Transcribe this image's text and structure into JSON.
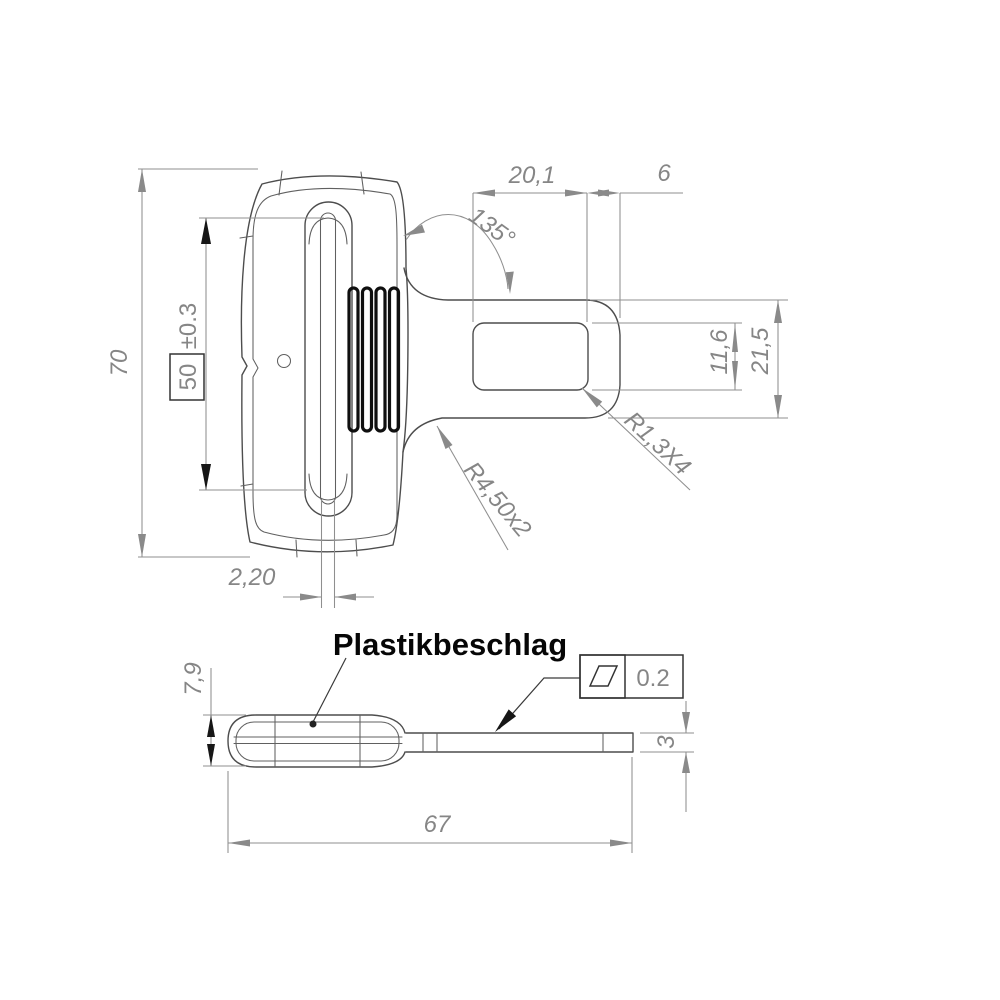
{
  "drawing": {
    "background": "#ffffff",
    "line_color": "#4d4d4d",
    "dim_color": "#8f8f8f",
    "emphasis_color": "#111111",
    "part_name": "Plastikbeschlag",
    "front_view": {
      "overall_height": "70",
      "slot_height_basic": "50",
      "slot_height_tolerance": "±0.3",
      "slot_width": "2,20",
      "tongue_slot_width": "20,1",
      "tongue_tip_width": "6",
      "neck_angle": "135°",
      "tongue_slot_height": "11,6",
      "tongue_height": "21,5",
      "slot_corner_radius": "R1,3X4",
      "neck_fillet_radius": "R4,50x2"
    },
    "side_view": {
      "body_thickness": "7,9",
      "overall_length": "67",
      "plate_thickness": "3",
      "surface_finish_value": "0.2"
    }
  }
}
